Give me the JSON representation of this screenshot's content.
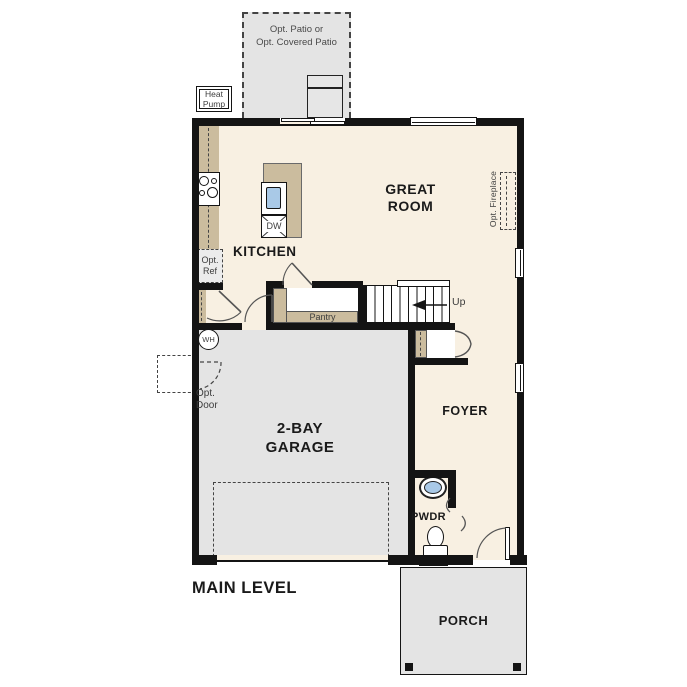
{
  "title": {
    "main_level": "MAIN LEVEL"
  },
  "rooms": {
    "great_room_l1": "GREAT",
    "great_room_l2": "ROOM",
    "kitchen": "KITCHEN",
    "garage_l1": "2-BAY",
    "garage_l2": "GARAGE",
    "foyer": "FOYER",
    "pwdr": "PWDR",
    "porch": "PORCH",
    "pantry": "Pantry"
  },
  "annotations": {
    "opt_patio_l1": "Opt. Patio or",
    "opt_patio_l2": "Opt. Covered Patio",
    "heat_pump_l1": "Heat",
    "heat_pump_l2": "Pump",
    "opt_ref_l1": "Opt.",
    "opt_ref_l2": "Ref",
    "opt_door_l1": "Opt.",
    "opt_door_l2": "Door",
    "opt_fireplace": "Opt. Fireplace",
    "up": "Up",
    "wh": "WH",
    "dw": "DW"
  },
  "colors": {
    "floor": "#f8f0e2",
    "concrete": "#e4e4e4",
    "counter": "#cbbc9e",
    "wall": "#141414",
    "sink": "#a9c9e7",
    "text": "#1a1a1a",
    "muted_text": "#3d3d3d",
    "dash": "#444444",
    "door_stroke": "#555555"
  }
}
